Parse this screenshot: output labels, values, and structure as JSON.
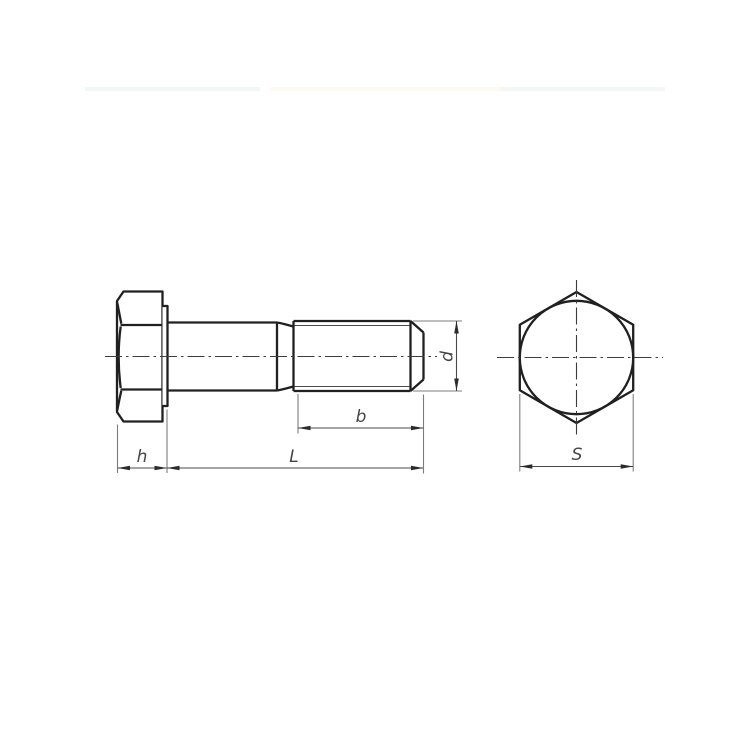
{
  "drawing": {
    "labels": {
      "head_height": "h",
      "total_length": "L",
      "thread_length": "b",
      "thread_diameter": "d",
      "width_across_flats": "S"
    },
    "colors": {
      "background": "#ffffff",
      "object_line": "#202020",
      "dimension_line": "#4a4a4a",
      "extension_line": "#7d7d7d",
      "centerline": "#3c3c3c",
      "label_text": "#454545"
    }
  }
}
